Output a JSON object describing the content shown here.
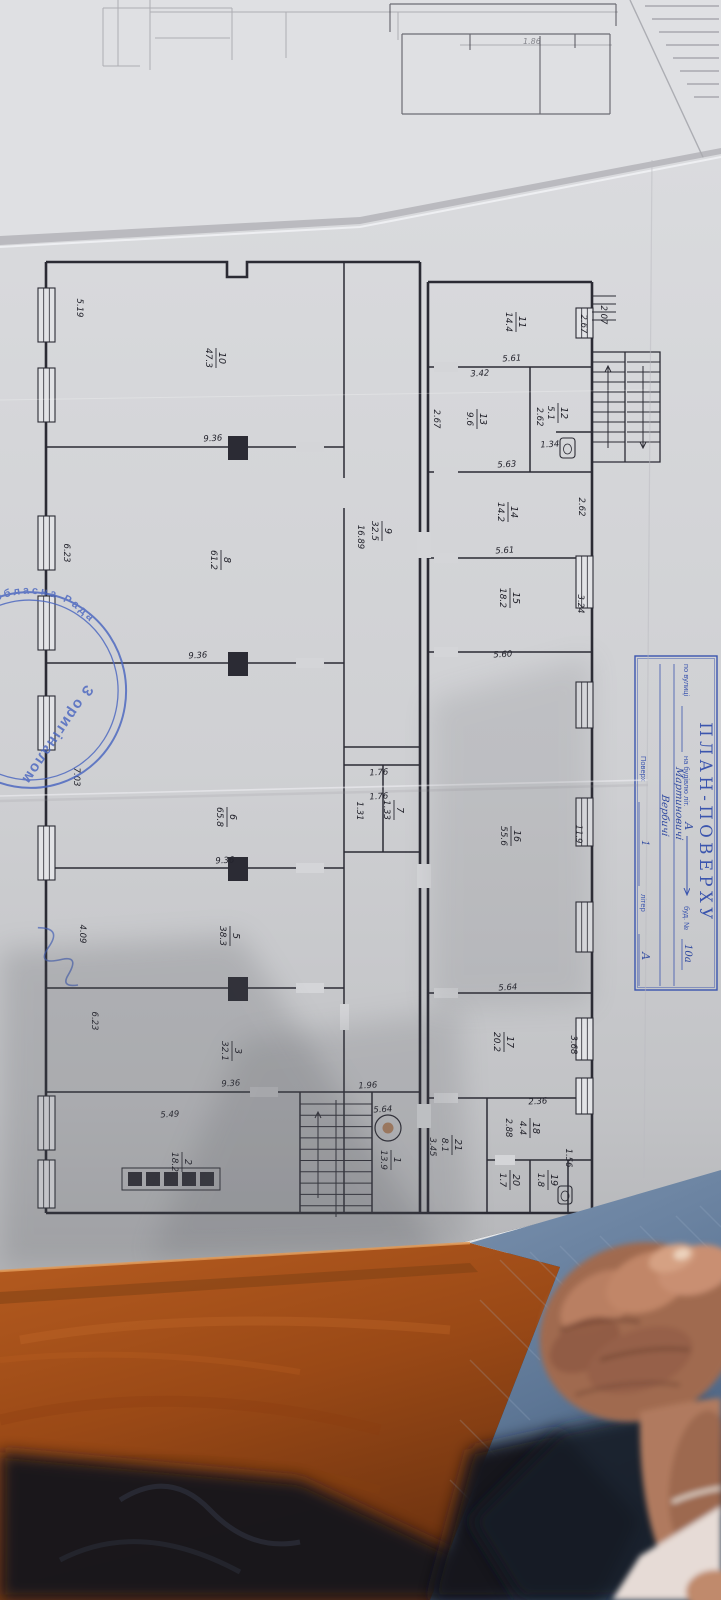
{
  "scene": {
    "paper": "#d6d7da",
    "paper_under": "#e7e8ea",
    "pencil_sheet": "#dfe0e3",
    "ink": "#2b2b34",
    "blue": "#3b55ae",
    "stamp_blue": "#4a66c0",
    "wood": "#ab5318",
    "wood_dark": "#773812",
    "denim": "#7188a6",
    "denim_dark": "#1a2030",
    "skin": "#b07a5e",
    "skin_light": "#cd9476",
    "dark": "#131419"
  },
  "title_block": {
    "title": "ПЛАН-ПОВЕРХУ",
    "street_label": "по вулиці",
    "street_value_1": "Мартиновичі",
    "street_value_2": "Вербичі",
    "building_label": "на будівлю літ.",
    "building_value": "А",
    "house_label": "буд. №",
    "house_value": "10а",
    "floor_label": "Поверх",
    "floor_value": "1",
    "letter_label": "літер",
    "letter_value": "А"
  },
  "stamp": {
    "ring_text": "ька обласна Рада",
    "center_text": "З оригіналом"
  },
  "plan": {
    "pencil_label": {
      "t": "1.86",
      "x": 523,
      "y": 44
    },
    "rooms": [
      {
        "n": "10",
        "a": "47.3",
        "x": 216,
        "y": 358
      },
      {
        "n": "8",
        "a": "61.2",
        "x": 221,
        "y": 560
      },
      {
        "n": "9",
        "a": "32.5",
        "x": 382,
        "y": 531
      },
      {
        "n": "6",
        "a": "65.8",
        "x": 227,
        "y": 817
      },
      {
        "n": "5",
        "a": "38.3",
        "x": 230,
        "y": 936
      },
      {
        "n": "3",
        "a": "32.1",
        "x": 232,
        "y": 1051
      },
      {
        "n": "2",
        "a": "18.2",
        "x": 182,
        "y": 1162
      },
      {
        "n": "1",
        "a": "13.9",
        "x": 391,
        "y": 1160
      },
      {
        "n": "7",
        "a": "1.33",
        "x": 394,
        "y": 810
      },
      {
        "n": "11",
        "a": "14.4",
        "x": 516,
        "y": 322
      },
      {
        "n": "13",
        "a": "9.6",
        "x": 477,
        "y": 419
      },
      {
        "n": "12",
        "a": "5.1",
        "x": 558,
        "y": 413
      },
      {
        "n": "14",
        "a": "14.2",
        "x": 508,
        "y": 512
      },
      {
        "n": "15",
        "a": "18.2",
        "x": 510,
        "y": 598
      },
      {
        "n": "16",
        "a": "55.6",
        "x": 511,
        "y": 836
      },
      {
        "n": "17",
        "a": "20.2",
        "x": 504,
        "y": 1042
      },
      {
        "n": "21",
        "a": "8.1",
        "x": 452,
        "y": 1145
      },
      {
        "n": "18",
        "a": "4.4",
        "x": 530,
        "y": 1128
      },
      {
        "n": "20",
        "a": "1.7",
        "x": 510,
        "y": 1180
      },
      {
        "n": "19",
        "a": "1.8",
        "x": 548,
        "y": 1180
      }
    ],
    "dims": [
      {
        "t": "9.36",
        "x": 213,
        "y": 441,
        "r": -3
      },
      {
        "t": "9.36",
        "x": 198,
        "y": 658,
        "r": -3
      },
      {
        "t": "9.36",
        "x": 225,
        "y": 863,
        "r": -3
      },
      {
        "t": "9.36",
        "x": 231,
        "y": 1086,
        "r": -3
      },
      {
        "t": "5.49",
        "x": 170,
        "y": 1117,
        "r": -3
      },
      {
        "t": "5.61",
        "x": 512,
        "y": 361,
        "r": -3
      },
      {
        "t": "3.42",
        "x": 480,
        "y": 376,
        "r": -3
      },
      {
        "t": "5.63",
        "x": 507,
        "y": 467,
        "r": -3
      },
      {
        "t": "5.61",
        "x": 505,
        "y": 553,
        "r": -3
      },
      {
        "t": "5.60",
        "x": 503,
        "y": 657,
        "r": -3
      },
      {
        "t": "5.64",
        "x": 508,
        "y": 990,
        "r": -3
      },
      {
        "t": "5.64",
        "x": 383,
        "y": 1112,
        "r": -3
      },
      {
        "t": "2.36",
        "x": 538,
        "y": 1104,
        "r": -3
      },
      {
        "t": "1.34",
        "x": 550,
        "y": 447,
        "r": -3
      },
      {
        "t": "1.76",
        "x": 379,
        "y": 775,
        "r": -3
      },
      {
        "t": "1.76",
        "x": 379,
        "y": 799,
        "r": -3
      },
      {
        "t": "1.96",
        "x": 368,
        "y": 1088,
        "r": -3
      },
      {
        "t": "5.19",
        "x": 77,
        "y": 308,
        "r": 90
      },
      {
        "t": "6.23",
        "x": 64,
        "y": 553,
        "r": 90
      },
      {
        "t": "7.03",
        "x": 74,
        "y": 777,
        "r": 90
      },
      {
        "t": "4.09",
        "x": 80,
        "y": 934,
        "r": 90
      },
      {
        "t": "6.23",
        "x": 92,
        "y": 1021,
        "r": 90
      },
      {
        "t": "2.07",
        "x": 601,
        "y": 315,
        "r": 90
      },
      {
        "t": "2.67",
        "x": 581,
        "y": 324,
        "r": 90
      },
      {
        "t": "2.67",
        "x": 434,
        "y": 419,
        "r": 90
      },
      {
        "t": "2.62",
        "x": 537,
        "y": 417,
        "r": 90
      },
      {
        "t": "2.62",
        "x": 579,
        "y": 507,
        "r": 90
      },
      {
        "t": "3.24",
        "x": 578,
        "y": 604,
        "r": 90
      },
      {
        "t": "11.9",
        "x": 576,
        "y": 834,
        "r": 90
      },
      {
        "t": "3.68",
        "x": 571,
        "y": 1045,
        "r": 90
      },
      {
        "t": "16.89",
        "x": 358,
        "y": 537,
        "r": 90
      },
      {
        "t": "1.31",
        "x": 357,
        "y": 811,
        "r": 90
      },
      {
        "t": "2.88",
        "x": 506,
        "y": 1128,
        "r": 90
      },
      {
        "t": "3.45",
        "x": 430,
        "y": 1147,
        "r": 90
      },
      {
        "t": "1.56",
        "x": 566,
        "y": 1158,
        "r": 90
      }
    ],
    "walls_outer": [
      "M46,262 H227 V277 H247 V262 H420",
      "M46,262 V1213",
      "M46,1213 H592",
      "M420,262 V1213",
      "M428,282 V1213",
      "M428,282 H592",
      "M592,282 V1213"
    ],
    "walls_inner": [
      "M344,262 V1213",
      "M46,447 H344",
      "M46,663 H344",
      "M46,868 H344",
      "M46,988 H344",
      "M46,1092 H420",
      "M300,1092 V1213",
      "M372,1092 V1213",
      "M344,747 H420",
      "M344,765 H420",
      "M344,852 H420",
      "M383,765 V852",
      "M428,367 H592",
      "M428,472 H592",
      "M428,558 H592",
      "M428,652 H592",
      "M428,993 H592",
      "M428,1098 H592",
      "M530,367 V472",
      "M556,432 H592",
      "M487,1098 V1213",
      "M487,1160 H592",
      "M530,1160 V1213",
      "M568,1160 V1213"
    ],
    "stair_frame": "M592,352 H660 V462 H592 Z M625,352 V462",
    "piers": [
      [
        228,
        436,
        20,
        24
      ],
      [
        228,
        652,
        20,
        24
      ],
      [
        228,
        857,
        20,
        24
      ],
      [
        228,
        977,
        20,
        24
      ]
    ],
    "gaps": [
      [
        340,
        478,
        9,
        30
      ],
      [
        340,
        1004,
        9,
        26
      ],
      [
        417,
        532,
        14,
        26
      ],
      [
        417,
        864,
        14,
        24
      ],
      [
        417,
        1104,
        14,
        24
      ],
      [
        296,
        442,
        28,
        10
      ],
      [
        296,
        658,
        28,
        10
      ],
      [
        296,
        863,
        28,
        10
      ],
      [
        296,
        983,
        28,
        10
      ],
      [
        250,
        1087,
        28,
        10
      ],
      [
        434,
        362,
        24,
        10
      ],
      [
        434,
        467,
        24,
        10
      ],
      [
        434,
        553,
        24,
        10
      ],
      [
        434,
        647,
        24,
        10
      ],
      [
        434,
        988,
        24,
        10
      ],
      [
        434,
        1093,
        24,
        10
      ],
      [
        495,
        1155,
        20,
        10
      ]
    ],
    "windows": [
      {
        "x": 38,
        "y": 288,
        "h": 54
      },
      {
        "x": 38,
        "y": 368,
        "h": 54
      },
      {
        "x": 38,
        "y": 516,
        "h": 54
      },
      {
        "x": 38,
        "y": 596,
        "h": 54
      },
      {
        "x": 38,
        "y": 696,
        "h": 54
      },
      {
        "x": 38,
        "y": 826,
        "h": 54
      },
      {
        "x": 38,
        "y": 1096,
        "h": 54
      },
      {
        "x": 38,
        "y": 1160,
        "h": 48
      },
      {
        "x": 576,
        "y": 308,
        "h": 30
      },
      {
        "x": 576,
        "y": 556,
        "h": 52
      },
      {
        "x": 576,
        "y": 682,
        "h": 46
      },
      {
        "x": 576,
        "y": 798,
        "h": 48
      },
      {
        "x": 576,
        "y": 902,
        "h": 50
      },
      {
        "x": 576,
        "y": 1018,
        "h": 42
      },
      {
        "x": 576,
        "y": 1078,
        "h": 36
      }
    ],
    "stairs_main": {
      "x1": 300,
      "x2": 372,
      "y": 1104,
      "step": 11.3,
      "n": 10,
      "rail": 336
    },
    "stairs_ext": {
      "x1": 592,
      "xm1": 625,
      "xm2": 627,
      "x2": 660,
      "y1": 352,
      "y2": 462,
      "step": 10,
      "n": 10
    },
    "steps_small": {
      "x1": 592,
      "x2": 616,
      "y": 296,
      "step": 8,
      "n": 4
    },
    "squares": {
      "x": 128,
      "y": 1172,
      "size": 14,
      "gap": 18,
      "n": 5
    },
    "circle": {
      "x": 388,
      "y": 1128,
      "r": 13
    },
    "toilets": [
      [
        560,
        438,
        15,
        20
      ],
      [
        558,
        1186,
        14,
        18
      ]
    ],
    "pencil_lines": [
      "M118,0 V66",
      "M150,0 V70",
      "M103,8 H232",
      "M103,8 V66",
      "M232,8 V60",
      "M150,12 H618",
      "M286,12 V58",
      "M398,12 V40",
      "M155,38 H230",
      "M460,45 H612",
      "M103,66 H140"
    ],
    "ink_fragment_lines": [
      "M390,4 H616",
      "M390,4 V32",
      "M402,34 V114",
      "M402,34 H610",
      "M610,34 V114",
      "M402,114 H610",
      "M540,36 V114",
      "M616,4 V26",
      "M470,34 V50",
      "M575,34 V48"
    ]
  }
}
